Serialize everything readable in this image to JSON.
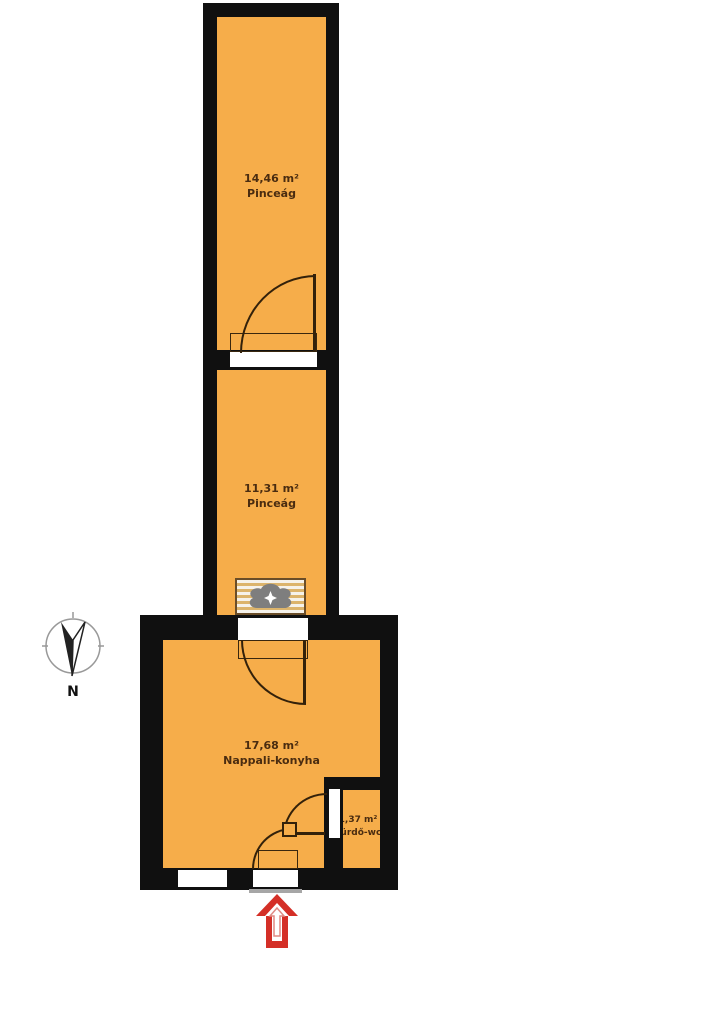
{
  "meta": {
    "type": "apartment floor plan"
  },
  "rooms": [
    {
      "area": "14,46 m²",
      "name": "Pinceág"
    },
    {
      "area": "11,31 m²",
      "name": "Pinceág"
    },
    {
      "area": "17,68 m²",
      "name": "Nappali-konyha"
    },
    {
      "area": "1,37 m²",
      "name": "Fürdő-wc"
    }
  ],
  "compass": {
    "label": "N"
  },
  "icons": {
    "compass": "compass-rose",
    "stove": "masonry-stove",
    "entrance": "entrance-arrow-up"
  },
  "colors": {
    "floor": "#F6AD4A",
    "wall": "#101010",
    "line": "#33210a",
    "text": "#4a2c10",
    "arrow_red": "#d42f27",
    "sill_gray": "#a6a6a6",
    "frame": "#3a270e"
  }
}
